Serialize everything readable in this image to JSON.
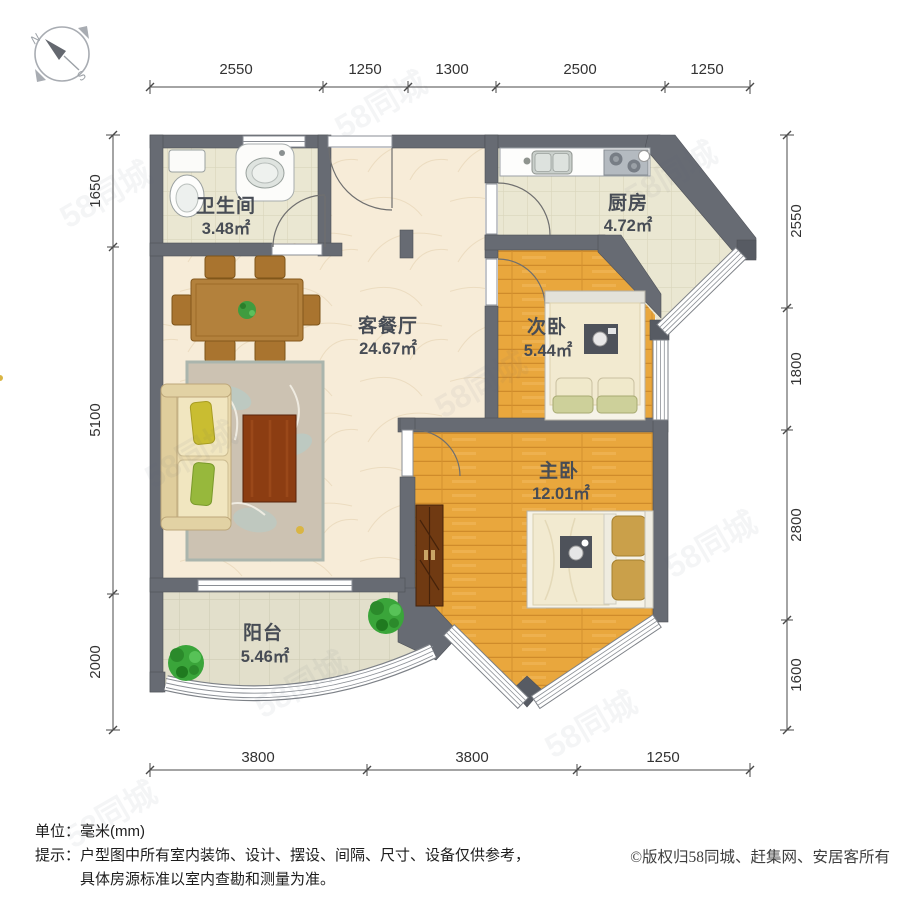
{
  "watermark": {
    "text": "58同城"
  },
  "compass": {
    "north": "N",
    "south": "S"
  },
  "rooms": [
    {
      "name": "卫生间",
      "area": "3.48㎡"
    },
    {
      "name": "厨房",
      "area": "4.72㎡"
    },
    {
      "name": "客餐厅",
      "area": "24.67㎡"
    },
    {
      "name": "次卧",
      "area": "5.44㎡"
    },
    {
      "name": "主卧",
      "area": "12.01㎡"
    },
    {
      "name": "阳台",
      "area": "5.46㎡"
    }
  ],
  "dimensions": {
    "top": [
      "2550",
      "1250",
      "1300",
      "2500",
      "1250"
    ],
    "bottom": [
      "3800",
      "3800",
      "1250"
    ],
    "left": [
      "1650",
      "5100",
      "2000"
    ],
    "right": [
      "2550",
      "1800",
      "2800",
      "1600"
    ]
  },
  "footer": {
    "unit_label": "单位：",
    "unit_value": "毫米(mm)",
    "tip_label": "提示：",
    "tip_line1": "户型图中所有室内装饰、设计、摆设、间隔、尺寸、设备仅供参考，",
    "tip_line2": "具体房源标准以室内查勘和测量为准。",
    "copyright": "©版权归58同城、赶集网、安居客所有"
  },
  "colors": {
    "wall": "#676b73",
    "wood_floor": "#e9a73d",
    "tile_floor": "#eae7d2",
    "living_floor": "#f7ecd8",
    "plant_green": "#35a435"
  }
}
